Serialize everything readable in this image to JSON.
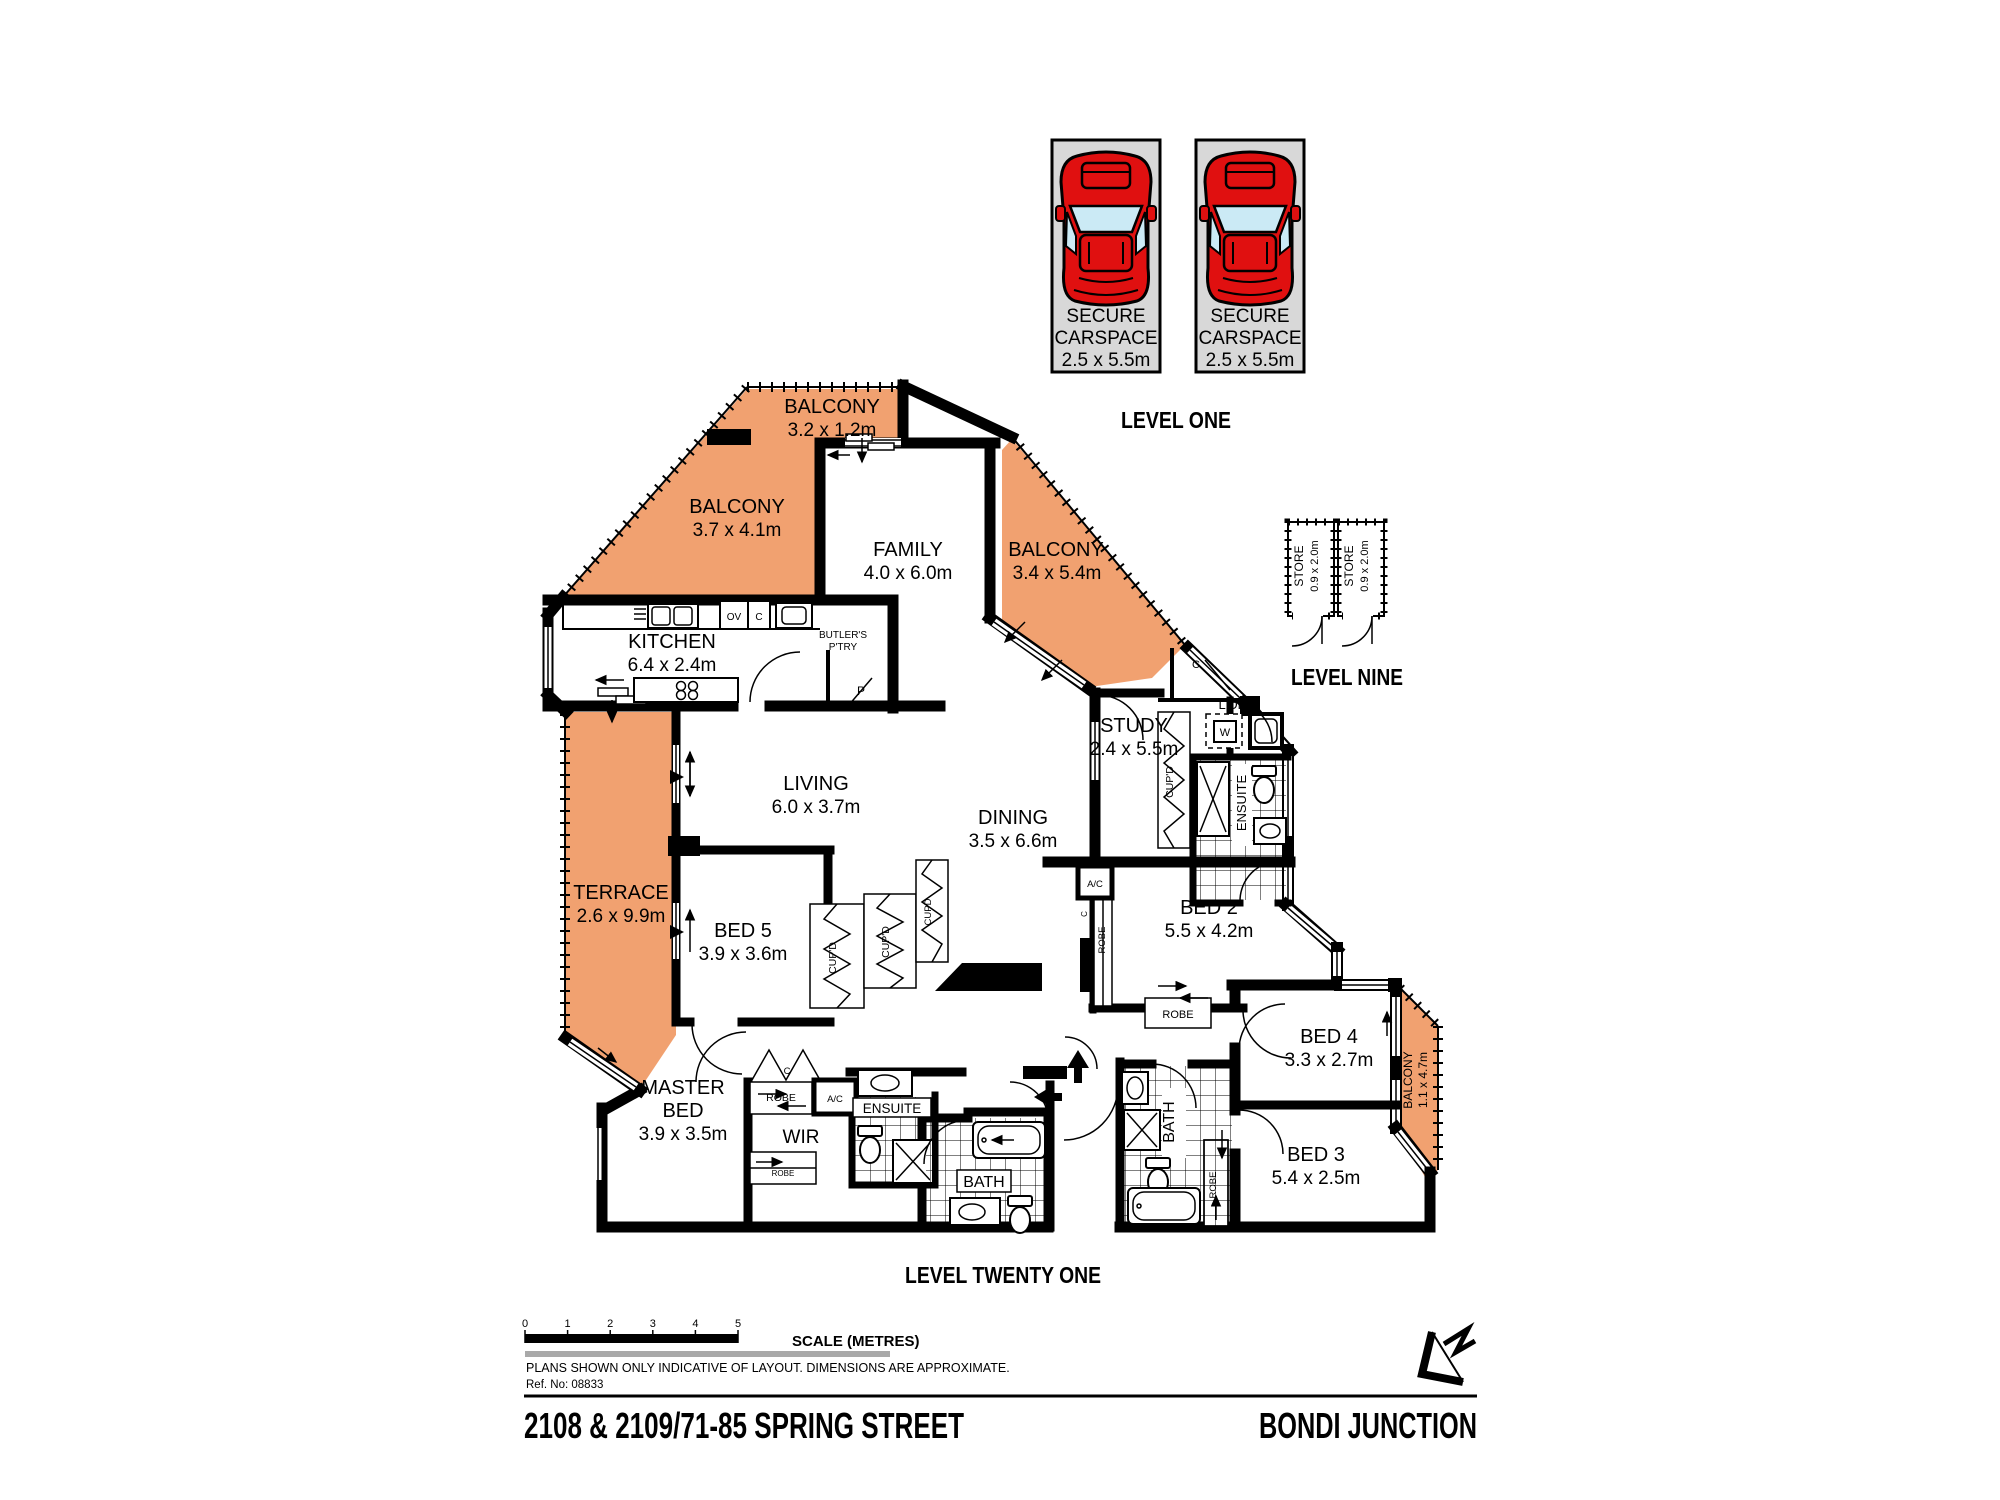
{
  "colors": {
    "balcony": "#F1A170",
    "carspace": "#D8D8D8",
    "car": "#E01010",
    "glass": "#CBEAF5",
    "gray_line": "#A9A9A9"
  },
  "levels": {
    "one": "LEVEL ONE",
    "nine": "LEVEL NINE",
    "twenty_one": "LEVEL TWENTY ONE"
  },
  "carspace": {
    "l1": "SECURE",
    "l2": "CARSPACE",
    "l3": "2.5 x 5.5m"
  },
  "store": {
    "name": "STORE",
    "dims": "0.9 x 2.0m"
  },
  "rooms": {
    "balcony_top": {
      "name": "BALCONY",
      "dims": "3.2 x 1.2m"
    },
    "balcony_left": {
      "name": "BALCONY",
      "dims": "3.7 x 4.1m"
    },
    "balcony_right": {
      "name": "BALCONY",
      "dims": "3.4 x 5.4m"
    },
    "balcony_small": {
      "name": "BALCONY",
      "dims": "1.1 x 4.7m"
    },
    "family": {
      "name": "FAMILY",
      "dims": "4.0 x 6.0m"
    },
    "kitchen": {
      "name": "KITCHEN",
      "dims": "6.4 x 2.4m"
    },
    "living": {
      "name": "LIVING",
      "dims": "6.0 x 3.7m"
    },
    "dining": {
      "name": "DINING",
      "dims": "3.5 x 6.6m"
    },
    "terrace": {
      "name": "TERRACE",
      "dims": "2.6 x 9.9m"
    },
    "study": {
      "name": "STUDY",
      "dims": "2.4 x 5.5m"
    },
    "bed2": {
      "name": "BED 2",
      "dims": "5.5 x 4.2m"
    },
    "bed3": {
      "name": "BED 3",
      "dims": "5.4 x 2.5m"
    },
    "bed4": {
      "name": "BED 4",
      "dims": "3.3 x 2.7m"
    },
    "bed5": {
      "name": "BED 5",
      "dims": "3.9 x 3.6m"
    },
    "master": {
      "l1": "MASTER",
      "l2": "BED",
      "dims": "3.9 x 3.5m"
    }
  },
  "labels": {
    "butlers_l1": "BUTLER'S",
    "butlers_l2": "P'TRY",
    "ldry": "L'DRY",
    "wir": "WIR",
    "ensuite": "ENSUITE",
    "bath": "BATH",
    "robe": "ROBE",
    "cupd": "CUP'D",
    "cupd_plain": "CUPD",
    "ov": "OV",
    "c": "C",
    "p": "P",
    "w": "W",
    "ac": "A/C"
  },
  "scale": {
    "title": "SCALE (METRES)",
    "ticks": [
      "0",
      "1",
      "2",
      "3",
      "4",
      "5"
    ]
  },
  "notes": {
    "disclaimer": "PLANS SHOWN ONLY INDICATIVE OF LAYOUT.  DIMENSIONS ARE APPROXIMATE.",
    "ref": "Ref. No: 08833"
  },
  "footer": {
    "address": "2108 & 2109/71-85 SPRING STREET",
    "locality": "BONDI JUNCTION"
  }
}
